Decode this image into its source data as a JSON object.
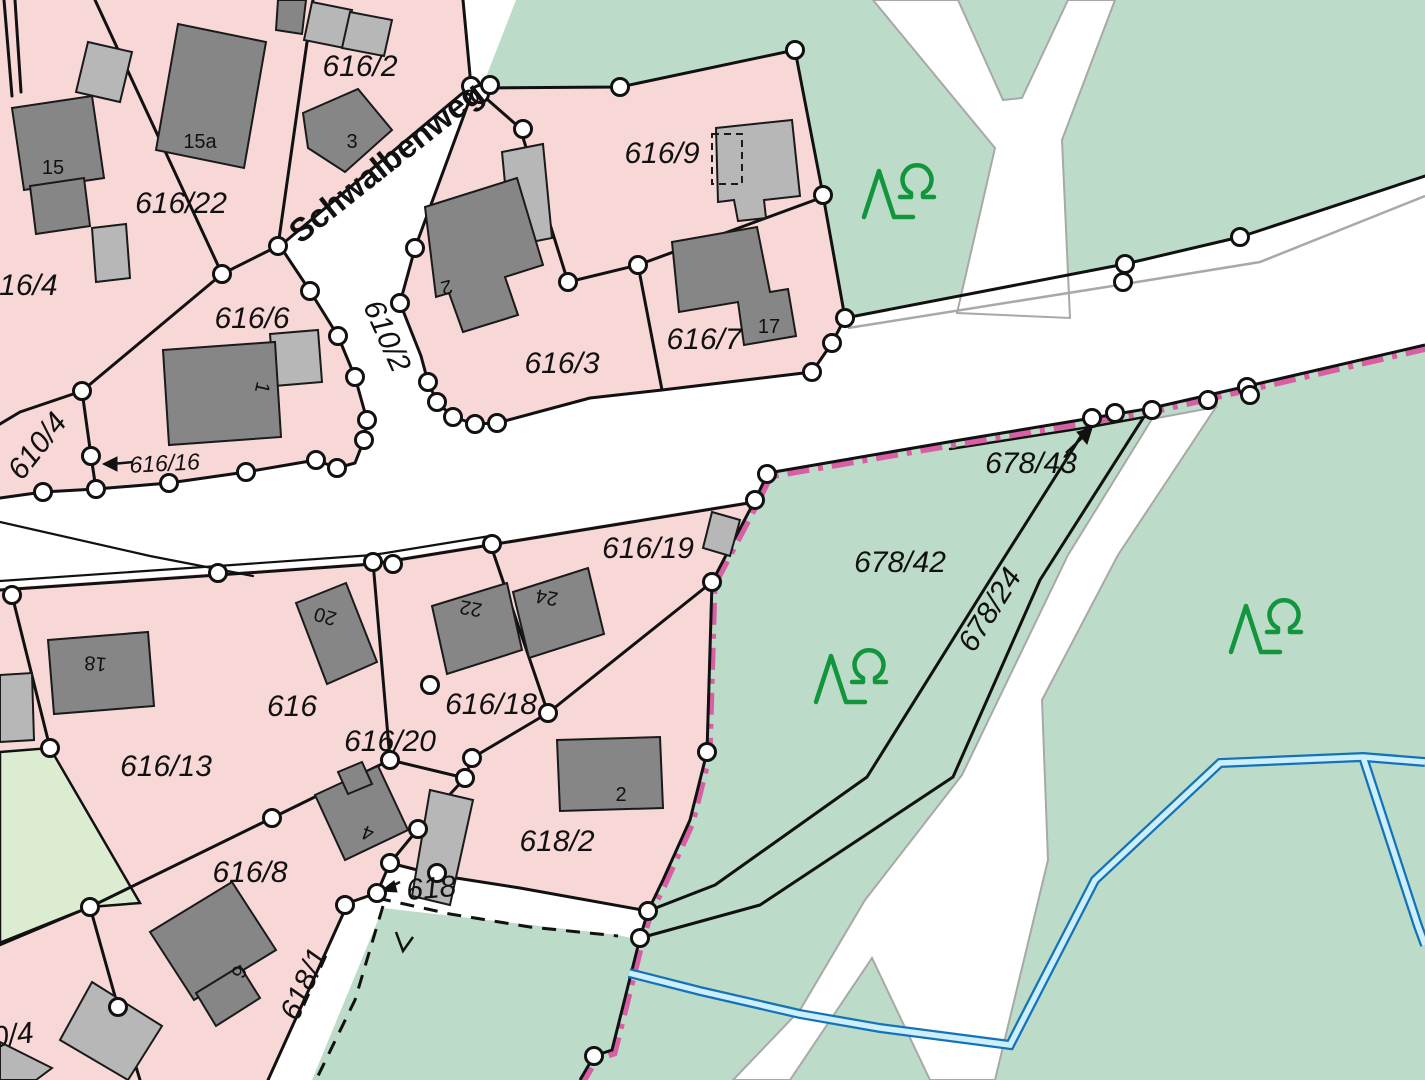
{
  "map": {
    "type": "cadastral-parcel-map",
    "street_name": "Schwalbenweg",
    "colors": {
      "residential": "#f8d7d7",
      "forest": "#bcdcc9",
      "meadow": "#dcecd1",
      "building_dark": "#868686",
      "building_light": "#b7b7b7",
      "boundary_line": "#111111",
      "municipal_boundary": "#d95fa4",
      "water_edge": "#1472b6",
      "water_fill": "#cdeefb",
      "road_edge": "#a8a8a8",
      "tree_symbol": "#12953c"
    }
  },
  "labels": [
    {
      "id": "street-schwalbenweg",
      "text": "Schwalbenweg",
      "x": 393,
      "y": 171,
      "rot": -38.5,
      "cls": "street-label"
    },
    {
      "id": "parcel-616-2",
      "text": "616/2",
      "x": 360,
      "y": 76,
      "rot": 0,
      "cls": "parcel-label"
    },
    {
      "id": "parcel-616-22",
      "text": "616/22",
      "x": 181,
      "y": 213,
      "rot": 0,
      "cls": "parcel-label"
    },
    {
      "id": "parcel-616-4",
      "text": "616/4",
      "x": 20,
      "y": 295,
      "rot": 0,
      "cls": "parcel-label"
    },
    {
      "id": "parcel-616-6",
      "text": "616/6",
      "x": 252,
      "y": 328,
      "rot": 0,
      "cls": "parcel-label"
    },
    {
      "id": "parcel-616-9",
      "text": "616/9",
      "x": 662,
      "y": 163,
      "rot": 0,
      "cls": "parcel-label"
    },
    {
      "id": "parcel-616-3",
      "text": "616/3",
      "x": 562,
      "y": 373,
      "rot": 0,
      "cls": "parcel-label"
    },
    {
      "id": "parcel-616-7",
      "text": "616/7",
      "x": 704,
      "y": 349,
      "rot": 0,
      "cls": "parcel-label"
    },
    {
      "id": "parcel-610-2",
      "text": "610/2",
      "x": 378,
      "y": 340,
      "rot": 66,
      "cls": "parcel-label"
    },
    {
      "id": "parcel-610-4",
      "text": "610/4",
      "x": 45,
      "y": 452,
      "rot": -52,
      "cls": "parcel-label"
    },
    {
      "id": "parcel-616-16",
      "text": "616/16",
      "x": 165,
      "y": 471,
      "rot": -3,
      "cls": "parcel-label small"
    },
    {
      "id": "parcel-616-19",
      "text": "616/19",
      "x": 648,
      "y": 558,
      "rot": 0,
      "cls": "parcel-label"
    },
    {
      "id": "parcel-678-43",
      "text": "678/43",
      "x": 1031,
      "y": 473,
      "rot": 0,
      "cls": "parcel-label"
    },
    {
      "id": "parcel-678-42",
      "text": "678/42",
      "x": 900,
      "y": 572,
      "rot": 0,
      "cls": "parcel-label"
    },
    {
      "id": "parcel-678-24",
      "text": "678/24",
      "x": 998,
      "y": 615,
      "rot": -58,
      "cls": "parcel-label"
    },
    {
      "id": "parcel-616-13",
      "text": "616/13",
      "x": 166,
      "y": 776,
      "rot": 0,
      "cls": "parcel-label"
    },
    {
      "id": "parcel-616",
      "text": "616",
      "x": 292,
      "y": 716,
      "rot": 0,
      "cls": "parcel-label"
    },
    {
      "id": "parcel-616-20",
      "text": "616/20",
      "x": 390,
      "y": 751,
      "rot": 0,
      "cls": "parcel-label"
    },
    {
      "id": "parcel-616-18",
      "text": "616/18",
      "x": 491,
      "y": 714,
      "rot": 0,
      "cls": "parcel-label"
    },
    {
      "id": "parcel-616-8",
      "text": "616/8",
      "x": 250,
      "y": 882,
      "rot": 0,
      "cls": "parcel-label"
    },
    {
      "id": "parcel-618-2",
      "text": "618/2",
      "x": 557,
      "y": 851,
      "rot": 0,
      "cls": "parcel-label"
    },
    {
      "id": "parcel-618",
      "text": "618",
      "x": 432,
      "y": 898,
      "rot": -5,
      "cls": "parcel-label"
    },
    {
      "id": "parcel-618-1",
      "text": "618/1",
      "x": 313,
      "y": 988,
      "rot": -66,
      "cls": "parcel-label"
    },
    {
      "id": "parcel-0-4",
      "text": "0/4",
      "x": 14,
      "y": 1045,
      "rot": -8,
      "cls": "parcel-label"
    },
    {
      "id": "house-15a",
      "text": "15a",
      "x": 200,
      "y": 148,
      "rot": 0,
      "cls": "house-label"
    },
    {
      "id": "house-15",
      "text": "15",
      "x": 53,
      "y": 174,
      "rot": 0,
      "cls": "house-label"
    },
    {
      "id": "house-3",
      "text": "3",
      "x": 352,
      "y": 148,
      "rot": 0,
      "cls": "house-label"
    },
    {
      "id": "house-2-616-3",
      "text": "2",
      "x": 445,
      "y": 281,
      "rot": 165,
      "cls": "house-label"
    },
    {
      "id": "house-1",
      "text": "1",
      "x": 256,
      "y": 386,
      "rot": 103,
      "cls": "house-label"
    },
    {
      "id": "house-17",
      "text": "17",
      "x": 769,
      "y": 333,
      "rot": 0,
      "cls": "house-label"
    },
    {
      "id": "house-18",
      "text": "18",
      "x": 96,
      "y": 657,
      "rot": 185,
      "cls": "house-label"
    },
    {
      "id": "house-20",
      "text": "20",
      "x": 327,
      "y": 610,
      "rot": 196,
      "cls": "house-label"
    },
    {
      "id": "house-22",
      "text": "22",
      "x": 472,
      "y": 602,
      "rot": 190,
      "cls": "house-label"
    },
    {
      "id": "house-24",
      "text": "24",
      "x": 548,
      "y": 591,
      "rot": 190,
      "cls": "house-label"
    },
    {
      "id": "house-4",
      "text": "4",
      "x": 370,
      "y": 827,
      "rot": 200,
      "cls": "house-label"
    },
    {
      "id": "house-2-618-2",
      "text": "2",
      "x": 621,
      "y": 801,
      "rot": 0,
      "cls": "house-label"
    },
    {
      "id": "house-6",
      "text": "6",
      "x": 233,
      "y": 969,
      "rot": 115,
      "cls": "house-label"
    }
  ],
  "trees": [
    {
      "id": "tree-symbol-1",
      "x": 886,
      "y": 193
    },
    {
      "id": "tree-symbol-2",
      "x": 838,
      "y": 678
    },
    {
      "id": "tree-symbol-3",
      "x": 1253,
      "y": 628
    }
  ],
  "boundary_points": [
    [
      222,
      274
    ],
    [
      278,
      246
    ],
    [
      310,
      291
    ],
    [
      338,
      336
    ],
    [
      355,
      377
    ],
    [
      367,
      420
    ],
    [
      364,
      440
    ],
    [
      415,
      248
    ],
    [
      400,
      303
    ],
    [
      428,
      382
    ],
    [
      437,
      402
    ],
    [
      453,
      417
    ],
    [
      475,
      424
    ],
    [
      497,
      423
    ],
    [
      523,
      129
    ],
    [
      568,
      282
    ],
    [
      638,
      265
    ],
    [
      620,
      87
    ],
    [
      795,
      50
    ],
    [
      823,
      195
    ],
    [
      845,
      318
    ],
    [
      832,
      343
    ],
    [
      812,
      372
    ],
    [
      471,
      86
    ],
    [
      480,
      94
    ],
    [
      490,
      85
    ],
    [
      82,
      391
    ],
    [
      91,
      456
    ],
    [
      96,
      489
    ],
    [
      43,
      492
    ],
    [
      169,
      483
    ],
    [
      246,
      472
    ],
    [
      316,
      460
    ],
    [
      337,
      468
    ],
    [
      12,
      595
    ],
    [
      218,
      573
    ],
    [
      373,
      562
    ],
    [
      393,
      564
    ],
    [
      492,
      544
    ],
    [
      712,
      582
    ],
    [
      755,
      500
    ],
    [
      767,
      474
    ],
    [
      707,
      752
    ],
    [
      50,
      748
    ],
    [
      390,
      760
    ],
    [
      272,
      818
    ],
    [
      90,
      907
    ],
    [
      118,
      1007
    ],
    [
      430,
      685
    ],
    [
      472,
      758
    ],
    [
      465,
      778
    ],
    [
      548,
      713
    ],
    [
      418,
      829
    ],
    [
      377,
      893
    ],
    [
      390,
      863
    ],
    [
      437,
      873
    ],
    [
      345,
      905
    ],
    [
      648,
      911
    ],
    [
      640,
      938
    ],
    [
      594,
      1056
    ],
    [
      1092,
      418
    ],
    [
      1115,
      413
    ],
    [
      1152,
      410
    ],
    [
      1208,
      400
    ],
    [
      1247,
      387
    ],
    [
      1250,
      395
    ],
    [
      1125,
      264
    ],
    [
      1123,
      282
    ],
    [
      1240,
      237
    ]
  ]
}
